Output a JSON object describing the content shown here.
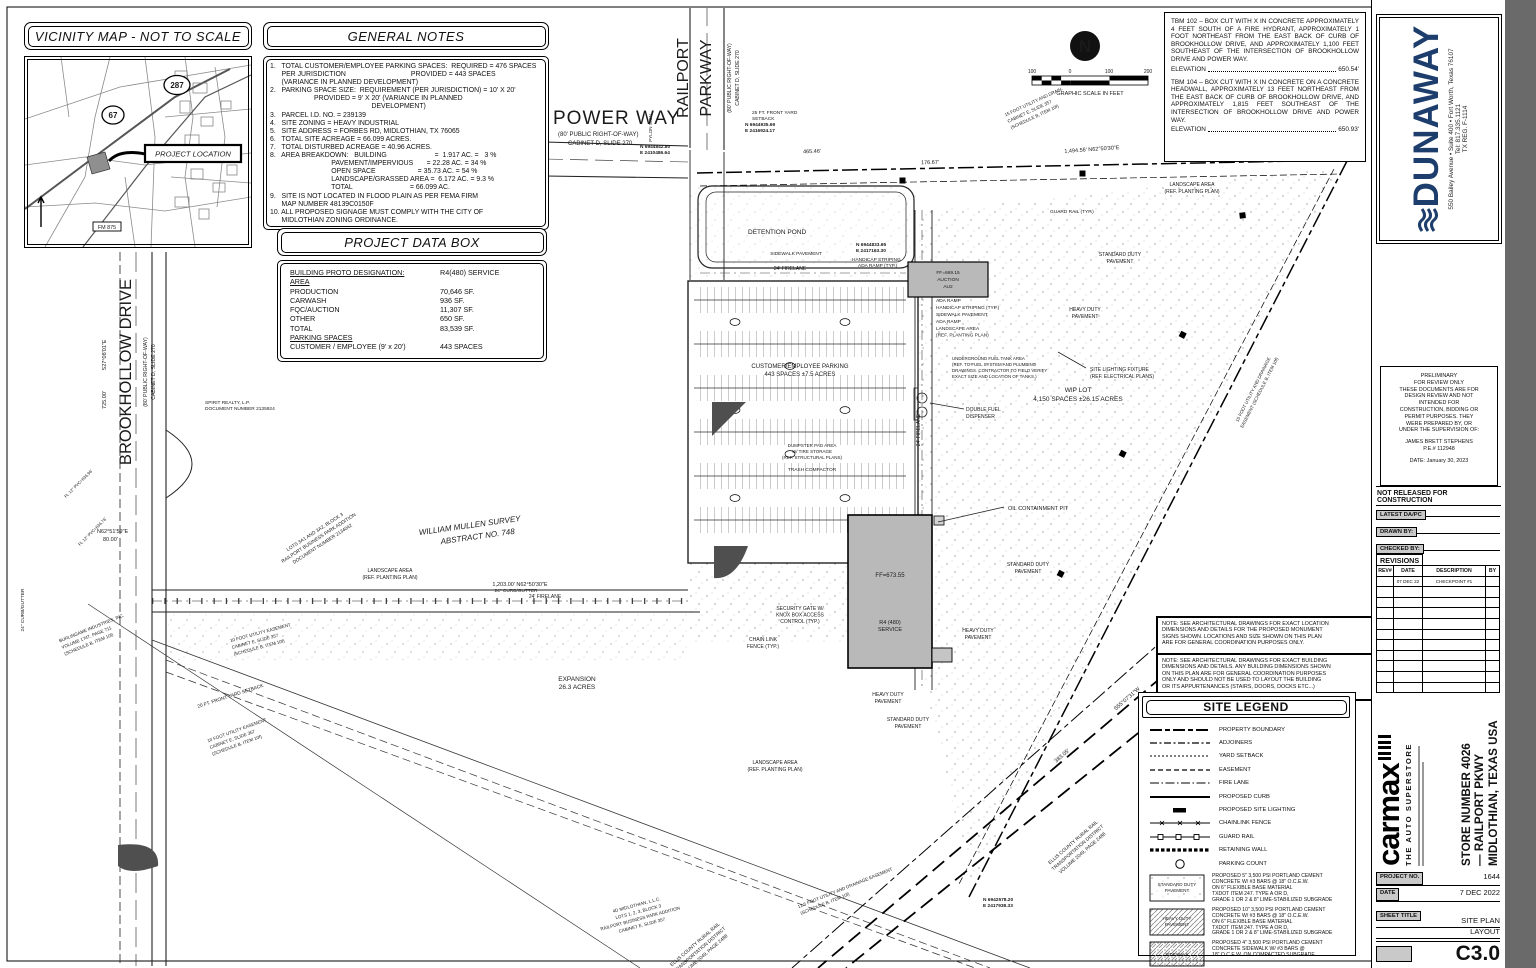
{
  "page": {
    "gray_band_color": "#6a6a6a"
  },
  "vicinity": {
    "title": "VICINITY MAP - NOT TO SCALE",
    "project_location": "PROJECT LOCATION",
    "hwy287": "287",
    "hwy67": "67",
    "fm875": "FM 875"
  },
  "general_notes": {
    "title": "GENERAL NOTES",
    "lines": [
      "1.   TOTAL CUSTOMER/EMPLOYEE PARKING SPACES:  REQUIRED = 476 SPACES",
      "      PER JURISDICTION                                  PROVIDED = 443 SPACES",
      "      (VARIANCE IN PLANNED DEVELOPMENT)",
      "2.   PARKING SPACE SIZE:  REQUIREMENT (PER JURISDICTION) = 10' X 20'",
      "                       PROVIDED = 9' X 20' (VARIANCE IN PLANNED",
      "                                                     DEVELOPMENT)",
      "3.   PARCEL I.D. NO. = 239139",
      "4.   SITE ZONING = HEAVY INDUSTRIAL",
      "5.   SITE ADDRESS = FORBES RD, MIDLOTHIAN, TX 76065",
      "6.   TOTAL SITE ACREAGE = 66.099 ACRES.",
      "7.   TOTAL DISTURBED ACREAGE = 40.96 ACRES.",
      "8.   AREA BREAKDOWN:   BUILDING                         =  1.917 AC. =   3 %",
      "                                PAVEMENT/IMPERVIOUS       = 22.28 AC. = 34 %",
      "                                OPEN SPACE                      = 35.73 AC. = 54 %",
      "                                LANDSCAPE/GRASSED AREA =  6.172 AC. = 9.3 %",
      "                                TOTAL                              = 66.099 AC.",
      "9.   SITE IS NOT LOCATED IN FLOOD PLAIN AS PER FEMA FIRM",
      "      MAP NUMBER 48139C0150F",
      "10. ALL PROPOSED SIGNAGE MUST COMPLY WITH THE CITY OF",
      "      MIDLOTHIAN ZONING ORDINANCE."
    ]
  },
  "project_data": {
    "title": "PROJECT DATA BOX",
    "rows": [
      [
        "BUILDING PROTO DESIGNATION:",
        "R4(480) SERVICE"
      ],
      [
        "AREA",
        ""
      ],
      [
        "PRODUCTION",
        "70,646 SF."
      ],
      [
        "CARWASH",
        "936 SF."
      ],
      [
        "FQC/AUCTION",
        "11,307 SF."
      ],
      [
        "OTHER",
        "650 SF."
      ],
      [
        "TOTAL",
        "83,539 SF."
      ],
      [
        "PARKING SPACES",
        ""
      ],
      [
        "CUSTOMER / EMPLOYEE (9' x 20')",
        "443 SPACES"
      ]
    ]
  },
  "tbm": {
    "p1": "TBM 102 – BOX CUT WITH X IN CONCRETE APPROXIMATELY 4 FEET SOUTH OF A FIRE HYDRANT, APPROXIMATELY 1 FOOT NORTHEAST FROM THE EAST BACK OF CURB OF BROOKHOLLOW DRIVE, AND APPROXIMATELY 1,100 FEET SOUTHEAST OF THE INTERSECTION OF BROOKHOLLOW DRIVE AND POWER WAY.",
    "e1_label": "ELEVATION",
    "e1_value": "650.54'",
    "p2": "TBM 104 – BOX CUT WITH X IN CONCRETE ON A CONCRETE HEADWALL, APPROXIMATELY 13 FEET NORTHEAST FROM THE EAST BACK OF CURB OF BROOKHOLLOW DRIVE, AND APPROXIMATELY 1,815 FEET SOUTHEAST OF THE INTERSECTION OF BROOKHOLLOW DRIVE AND POWER WAY.",
    "e2_label": "ELEVATION",
    "e2_value": "650.93'"
  },
  "dunaway": {
    "name": "DUNAWAY",
    "addr": "550 Bailey Avenue • Suite 400 • Fort Worth, Texas 76107",
    "tel": "Tel: 817.335.1121",
    "reg": "TX REG. F-1114",
    "color": "#1d3e6d"
  },
  "preliminary": {
    "lines": [
      "PRELIMINARY",
      "FOR REVIEW ONLY",
      "THESE DOCUMENTS ARE FOR",
      "DESIGN REVIEW AND NOT",
      "INTENDED FOR",
      "CONSTRUCTION, BIDDING OR",
      "PERMIT PURPOSES. THEY",
      "WERE PREPARED BY, OR",
      "UNDER THE SUPERVISION OF:",
      "JAMES BRETT STEPHENS",
      "P.E.# 112948",
      "DATE: January 30, 2023"
    ]
  },
  "title_block": {
    "not_released": "NOT RELEASED FOR CONSTRUCTION",
    "latest": "LATEST DA/PC",
    "drawn": "DRAWN BY:",
    "checked": "CHECKED BY:",
    "revisions": "REVISIONS",
    "rev_headers": [
      "REV#",
      "DATE",
      "DESCRIPTION",
      "BY"
    ],
    "rev_row_date": "07 DEC 22",
    "rev_row_desc": "CHECKPOINT #1"
  },
  "carmax": {
    "wordmark": "carmax",
    "tagline": "THE AUTO SUPERSTORE",
    "store_lines": [
      "STORE NUMBER 4026",
      "— RAILPORT PKWY",
      "MIDLOTHIAN, TEXAS USA"
    ]
  },
  "project_info": {
    "project_no_label": "PROJECT NO.",
    "project_no": "1644",
    "date_label": "DATE",
    "date": "7 DEC 2022",
    "sheet_title_label": "SHEET TITLE",
    "sheet_title_lines": [
      "SITE PLAN",
      "LAYOUT"
    ],
    "sheet_number": "C3.0"
  },
  "arch_notes": {
    "n1": [
      "NOTE: SEE ARCHITECTURAL DRAWINGS FOR EXACT LOCATION",
      "DIMENSIONS AND DETAILS FOR THE PROPOSED MONUMENT",
      "SIGNS SHOWN. LOCATIONS AND SIZE SHOWN ON THIS PLAN",
      "ARE FOR GENERAL COORDINATION PURPOSES ONLY."
    ],
    "n2": [
      "NOTE: SEE ARCHITECTURAL DRAWINGS FOR EXACT BUILDING",
      "DIMENSIONS AND DETAILS.  ANY BUILDING DIMENSIONS SHOWN",
      "ON THIS PLAN ARE FOR GENERAL COORDINATION PURPOSES",
      "ONLY AND SHOULD NOT BE USED TO LAYOUT THE BUILDING",
      "OR ITS APPURTENANCES (STAIRS, DOORS, DOCKS ETC...)"
    ]
  },
  "site_legend": {
    "title": "SITE LEGEND",
    "items": [
      "PROPERTY BOUNDARY",
      "ADJOINERS",
      "YARD SETBACK",
      "EASEMENT",
      "FIRE LANE",
      "PROPOSED CURB",
      "PROPOSED SITE LIGHTING",
      "CHAINLINK FENCE",
      "GUARD RAIL",
      "RETAINING WALL",
      "PARKING COUNT"
    ],
    "pavements": [
      {
        "name_lines": [
          "STANDARD DUTY",
          "PAVEMENT"
        ],
        "desc_lines": [
          "PROPOSED 5\" 3,500 PSI PORTLAND CEMENT",
          "CONCRETE W/ #3 BARS @ 18\" O.C.E.W.",
          "ON 6\" FLEXIBLE BASE MATERIAL",
          "TXDOT ITEM 247. TYPE A OR D,",
          "GRADE 1 OR 2 & 8\" LIME-STABILIZED SUBGRADE"
        ]
      },
      {
        "name_lines": [
          "HEAVY DUTY",
          "PAVEMENT"
        ],
        "desc_lines": [
          "PROPOSED 10\" 3,500 PSI PORTLAND CEMENT",
          "CONCRETE W/ #3 BARS @ 18\" O.C.E.W.",
          "ON 6\" FLEXIBLE BASE MATERIAL",
          "TXDOT ITEM 247. TYPE A OR D,",
          "GRADE 1 OR 2 & 8\" LIME-STABILIZED SUBGRADE"
        ]
      },
      {
        "name_lines": [
          "SIDEWALK",
          ""
        ],
        "desc_lines": [
          "PROPOSED 4\" 3,500 PSI PORTLAND CEMENT",
          "CONCRETE SIDEWALK W/ #3 BARS @",
          "18\" O.C.E.W. ON COMPACTED SUBGRADE"
        ]
      }
    ]
  },
  "plan": {
    "north": "N",
    "scale": {
      "l1": "100",
      "l2": "0",
      "l3": "100",
      "l4": "200",
      "caption": "GRAPHIC SCALE IN FEET"
    },
    "roads": {
      "power_way": [
        "POWER WAY",
        "(80' PUBLIC RIGHT-OF-WAY)",
        "CABINET D, SLIDE 270"
      ],
      "railport": [
        "RAILPORT",
        "PARKWAY",
        "(80' PUBLIC RIGHT-OF-WAY)",
        "CABINET D, SLIDE 270"
      ],
      "brookhollow": [
        "BROOKHOLLOW DRIVE",
        "(80' PUBLIC RIGHT-OF-WAY)",
        "CABINET D, SLIDE 270"
      ]
    },
    "areas": {
      "detention": "DETENTION POND",
      "parking": [
        "CUSTOMER/EMPLOYEE PARKING",
        "443 SPACES ±7.5 ACRES"
      ],
      "wip": [
        "WIP LOT",
        "4,150 SPACES ±26.15 ACRES"
      ],
      "expansion": [
        "EXPANSION",
        "26.3 ACRES"
      ],
      "survey": [
        "WILLIAM MULLEN SURVEY",
        "ABSTRACT NO. 748"
      ]
    },
    "buildings": {
      "main": [
        "FF=673.55",
        "R4 (480)",
        "SERVICE"
      ],
      "auction": [
        "FF=669.15",
        "AUCTION",
        "AU2"
      ]
    },
    "bearings": {
      "top1": "465.46'",
      "top2": "176.67'",
      "top3": "1,494.56'  N62°50'30\"E",
      "mid": "1,203.00'   N62°50'30\"E",
      "left1": "S27°08'01\"E",
      "left2": "725.00'",
      "left3": "N62°51'59\"E",
      "left4": "80.00'",
      "rail1": "383.05'",
      "rail2": "S55°07'31\"W"
    },
    "coords": {
      "c1": [
        "N 6944842.80",
        "E 2410486.64"
      ],
      "c2": [
        "N 6944935.69",
        "E 2416924.17"
      ],
      "c3": [
        "N 6944833.65",
        "E 2417163.30"
      ],
      "c4": [
        "N 6942578.20",
        "E 2417938.33"
      ]
    },
    "callouts": {
      "oil": "OIL CONTAINMENT PIT",
      "lighting": [
        "SITE LIGHTING FIXTURE",
        "(REF. ELECTRICAL PLANS)"
      ],
      "heavy": [
        "HEAVY DUTY",
        "PAVEMENT"
      ],
      "standard": [
        "STANDARD DUTY",
        "PAVEMENT"
      ],
      "landscape": [
        "LANDSCAPE AREA",
        "(REF. PLANTING PLAN)"
      ],
      "firelane": "24' FIRELANE",
      "chain": [
        "CHAIN LINK",
        "FENCE (TYP.)"
      ],
      "gate": [
        "SECURITY GATE W/",
        "KNOX BOX ACCESS",
        "CONTROL (TYP.)"
      ],
      "setback25": [
        "25 FT. FRONT YARD",
        "SETBACK"
      ],
      "setback20": "20 FT. FRONT YARD SETBACK",
      "sidewalk": "SIDEWALK PAVEMENT",
      "handicap": [
        "HANDICAP STRIPING",
        "ADA RAMP (TYP.)"
      ],
      "adastack": [
        "ADA RAMP",
        "HANDICAP STRIPING (TYP.)",
        "SIDEWALK PAVEMENT",
        "ADA RAMP",
        "LANDSCAPE AREA",
        "(REF. PLANTING PLAN)"
      ],
      "dumpster": [
        "DUMPSTER PAD AREA",
        "W/ TIRE STORAGE",
        "(REF. STRUCTURAL PLANS)"
      ],
      "compactor": "TRASH COMPACTOR",
      "fuel": [
        "DOUBLE FUEL",
        "DISPENSER"
      ],
      "ugtank": [
        "UNDERGROUND FUEL TANK AREA",
        "(REF. TO FUEL SYSTEM AND PLUMBING",
        "DRAWINGS. CONTRACTOR TO FIELD VERIFY",
        "EXACT SIZE AND LOCATION OF TANKS.)"
      ],
      "guard": "GUARD RAIL (TYP.)",
      "curb": "24\" CURB/GUTTER",
      "ellis": [
        "ELLIS COUNTY RURAL RAIL",
        "TRANSPORTATION DISTRICT",
        "VOLUME 2049, PAGE 2488"
      ],
      "spirit": [
        "SPIRIT REALTY, L.P.",
        "DOCUMENT NUMBER 2135924"
      ],
      "burlingame": [
        "BURLINGAME INDUSTRIES, INC.",
        "VOLUME 1747, PAGE 711",
        "(SCHEDULE B, ITEM 10f)"
      ],
      "lots3": [
        "LOTS 3A1 AND 3A2, BLOCK 3",
        "RAILPORT BUSINESS PARK ADDITION",
        "DOCUMENT NUMBER 2134042"
      ],
      "util10": [
        "10 FOOT UTILITY EASEMENT",
        "CABINET E, SLIDE 357",
        "(SCHEDULE B, ITEM 10f)"
      ],
      "util15": [
        "15 FOOT UTILITY AND DRAIN.",
        "CABINET E, SLIDE 357",
        "(SCHEDULE B, ITEM 10f)"
      ],
      "util15b": [
        "15 FOOT UTILITY AND DRAINAGE",
        "EASEMENT (SCHEDULE B, ITEM 10f)"
      ],
      "util125": [
        "12.5 FOOT UTILITY AND DRAINAGE EASEMENT",
        "(SCHEDULE B, ITEM 10f)"
      ],
      "midlothian": [
        "4D MIDLOTHIAN, L.L.C.",
        "LOTS 1, 2, 3, BLOCK 3",
        "RAILPORT BUSINESS PARK ADDITION",
        "CABINET E, SLIDE 357"
      ],
      "pylon": "PYLON SIGN",
      "fl1": "FL 12\" PVC=636.96'",
      "fl2": "FL 12\" PVC=636.76'"
    }
  }
}
